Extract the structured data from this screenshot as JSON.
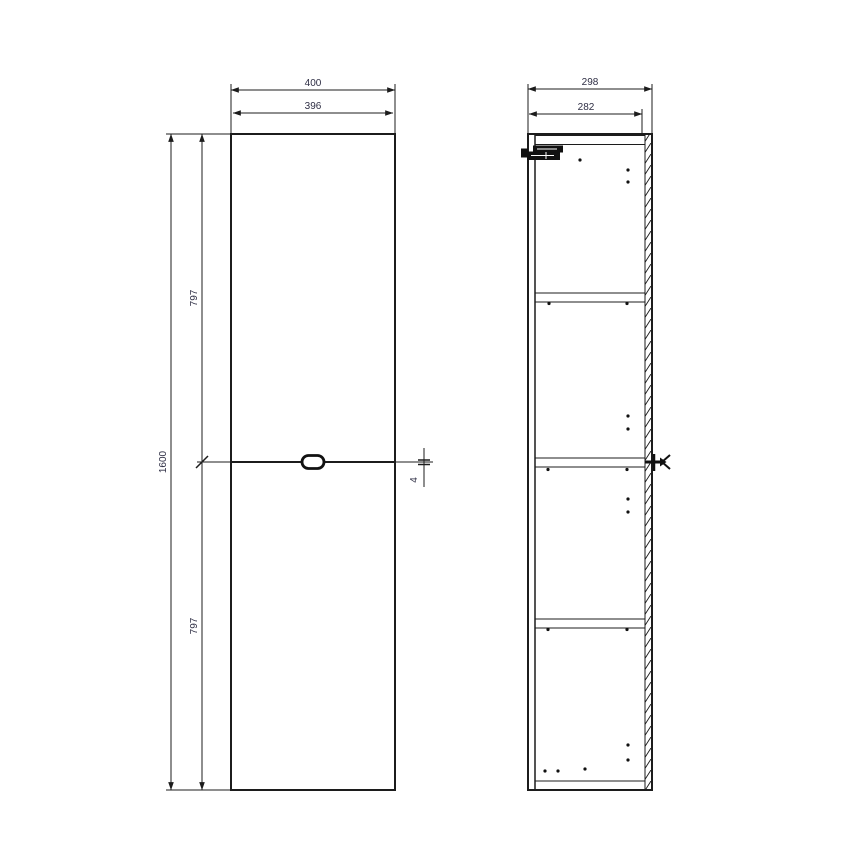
{
  "drawing": {
    "title": "tall-cabinet-technical-drawing",
    "colors": {
      "background": "#ffffff",
      "line": "#1c1c1c",
      "dimension_text": "#2e2e44"
    },
    "front_view": {
      "dim_width_outer": "400",
      "dim_width_inner": "396",
      "dim_height_total": "1600",
      "dim_height_upper": "797",
      "dim_height_lower": "797",
      "dim_door_gap": "4"
    },
    "side_view": {
      "dim_depth_outer": "298",
      "dim_depth_inner": "282"
    },
    "symbols": {
      "hinge": "door-hinge-hardware",
      "handle": "door-handle-knob",
      "bracket": "wall-mount-bracket",
      "pin_holes": "shelf-pin-holes",
      "hatch": "section-hatching"
    }
  }
}
